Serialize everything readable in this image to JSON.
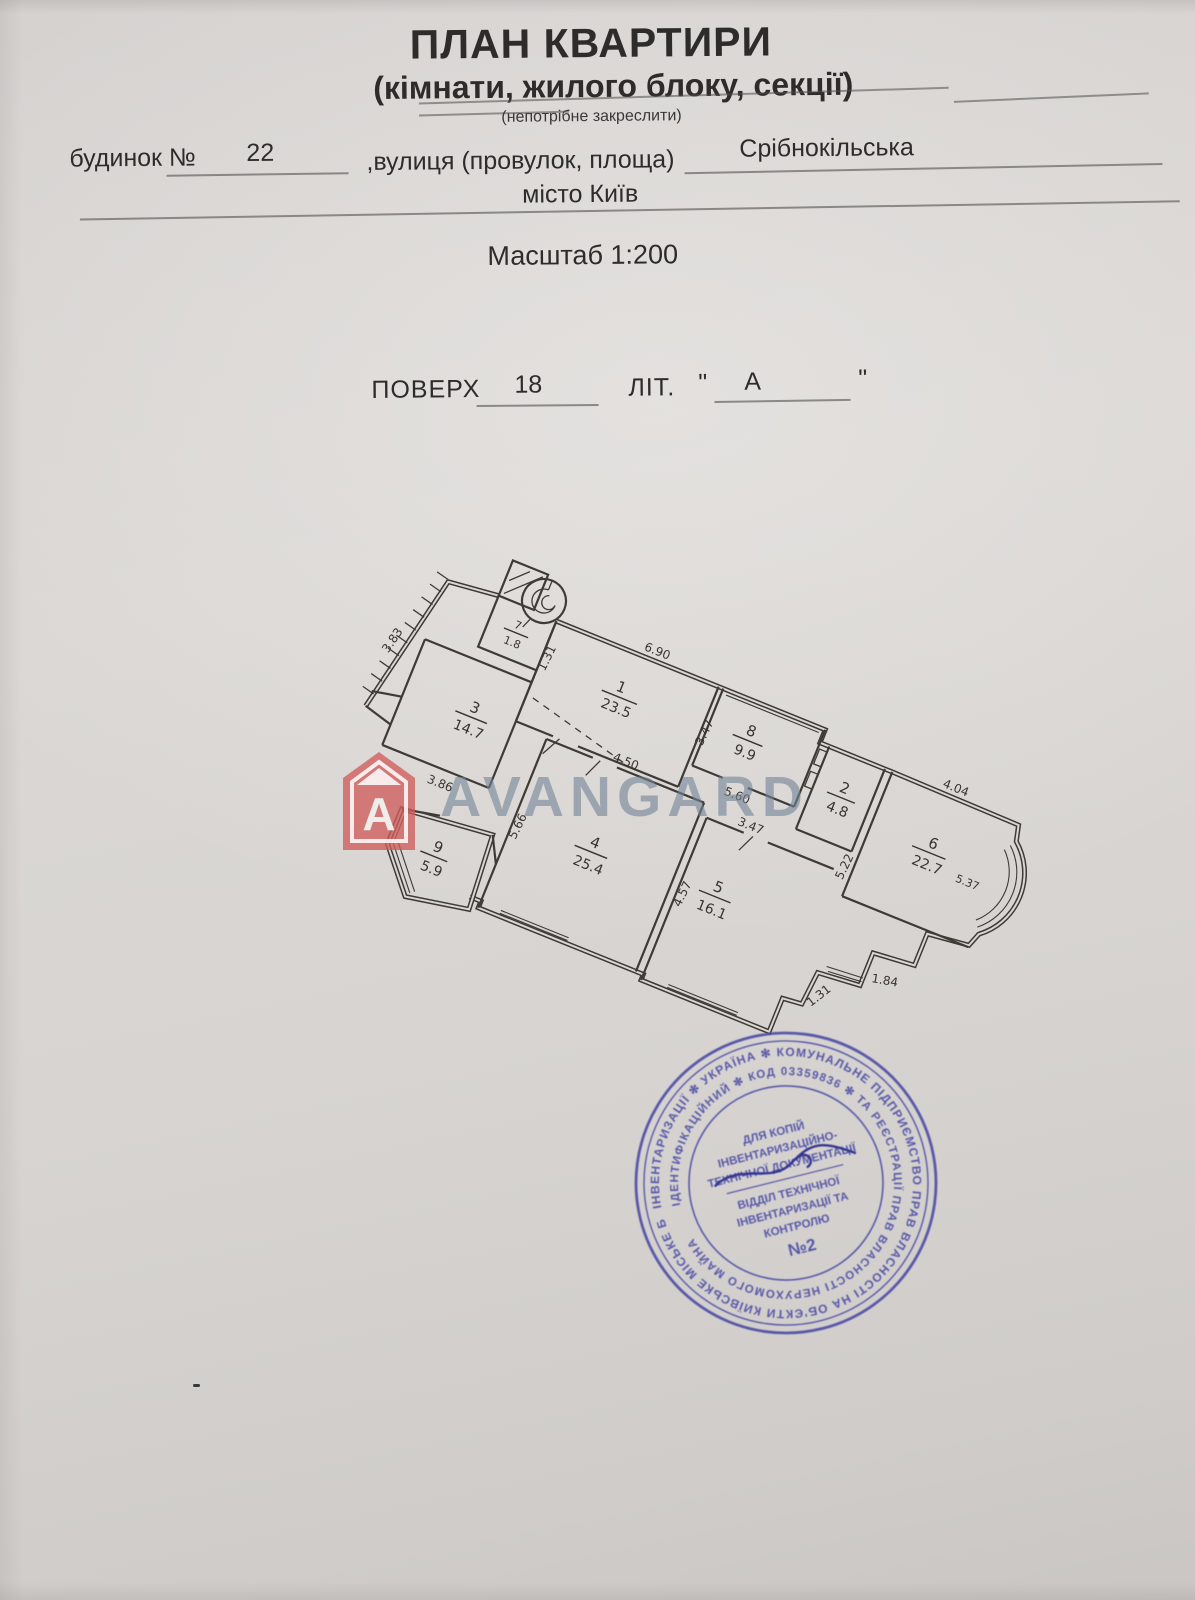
{
  "header": {
    "title": "ПЛАН КВАРТИРИ",
    "subtitle": "(кімнати, жилого блоку, секції)",
    "note": "(непотрібне закреслити)",
    "building_label": "будинок №",
    "building_number": "22",
    "street_label": ",вулиця (провулок, площа)",
    "street_value": "Срібнокільська",
    "city": "місто Київ",
    "scale": "Масштаб 1:200",
    "floor_label": "ПОВЕРХ",
    "floor_value": "18",
    "letter_label": "ЛІТ.",
    "quote_open": "\"",
    "letter_value": "А",
    "quote_close": "\""
  },
  "watermark": {
    "logo_letter": "A",
    "text": "AVANGARD"
  },
  "plan": {
    "rooms": {
      "r1": {
        "n": "1",
        "a": "23.5"
      },
      "r2": {
        "n": "2",
        "a": "4.8"
      },
      "r3": {
        "n": "3",
        "a": "14.7"
      },
      "r4": {
        "n": "4",
        "a": "25.4"
      },
      "r5": {
        "n": "5",
        "a": "16.1"
      },
      "r6": {
        "n": "6",
        "a": "22.7"
      },
      "r6x": "5.37",
      "r7": {
        "n": "7",
        "a": "1.8"
      },
      "r8": {
        "n": "8",
        "a": "9.9"
      },
      "r9": {
        "n": "9",
        "a": "5.9"
      }
    },
    "dims": {
      "d690": "6.90",
      "d347a": "3.47",
      "d131a": "1.31",
      "d383": "3.83",
      "d386": "3.86",
      "d450": "4.50",
      "d566": "5.66",
      "d560": "5.60",
      "d457": "4.57",
      "d347b": "3.47",
      "d522": "5.22",
      "d404": "4.04",
      "d131b": "1.31",
      "d184": "1.84"
    }
  },
  "stamp": {
    "outer_ring": "ІНВЕНТАРИЗАЦІЇ ✻ УКРАЇНА ✻ КОМУНАЛЬНЕ ПІДПРИЄМСТВО ПРАВ ВЛАСНОСТІ НА ОБ'ЄКТИ КИЇВСЬКЕ МІСЬКЕ БЮРО ТЕХНІЧНОЇ",
    "middle_ring": "ІДЕНТИФІКАЦІЙНИЙ ✻ КОД 03359836 ✻ ТА РЕЄСТРАЦІЇ ПРАВ ВЛАСНОСТІ НЕРУХОМОГО МАЙНА",
    "center": {
      "l1": "ДЛЯ КОПІЙ",
      "l2": "ІНВЕНТАРИЗАЦІЙНО-",
      "l3": "ТЕХНІЧНОЇ ДОКУМЕНТАЦІЇ",
      "l4": "ВІДДІЛ ТЕХНІЧНОЇ",
      "l5": "ІНВЕНТАРИЗАЦІЇ ТА",
      "l6": "КОНТРОЛЮ",
      "l7": "№2"
    }
  }
}
